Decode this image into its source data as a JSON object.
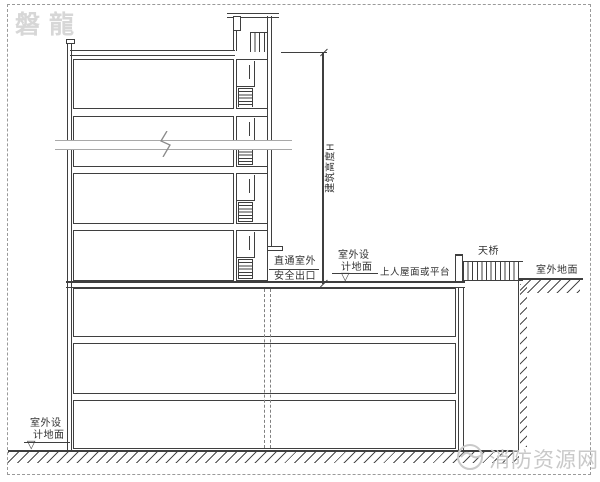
{
  "diagram": {
    "type": "building-section-drawing",
    "description_of_scene": "Section of a tower on a podium showing how building height H is measured",
    "colors": {
      "background": "#ffffff",
      "line": "#3f3f3f",
      "break_line": "#a9a9a9",
      "frame_dash": "#9a9a9a",
      "watermark": "#cccccc"
    }
  },
  "labels": {
    "building_height": "建筑高度H",
    "exit_line1": "直通室外",
    "exit_line2": "安全出口",
    "design_ground_line1": "室外设",
    "design_ground_line2": "计地面",
    "roof_platform": "上人屋面或平台",
    "bridge": "天桥",
    "outdoor_ground": "室外地面",
    "level_symbol": "▽"
  },
  "watermarks": {
    "top_left": "磐龍",
    "bottom_right": "消防资源网",
    "logo": "fire-dragon-logo"
  }
}
